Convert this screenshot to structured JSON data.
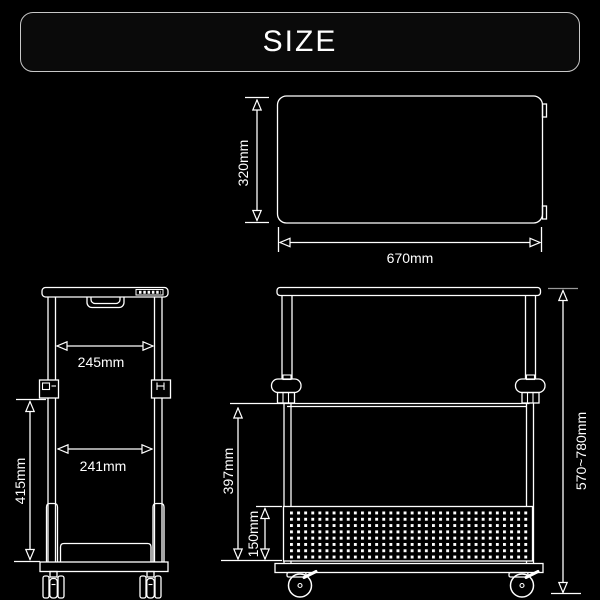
{
  "header": {
    "title": "SIZE"
  },
  "top_view": {
    "depth_label": "320mm",
    "width_label": "670mm"
  },
  "side_view": {
    "top_width_label": "245mm",
    "bottom_width_label": "241mm",
    "height_label": "415mm"
  },
  "front_view": {
    "shelf_height_label": "397mm",
    "panel_height_label": "150mm",
    "total_height_label": "570~780mm"
  },
  "colors": {
    "background": "#000000",
    "line": "#ffffff",
    "banner_border": "#c8c8c8",
    "extension_gray": "#999999"
  }
}
